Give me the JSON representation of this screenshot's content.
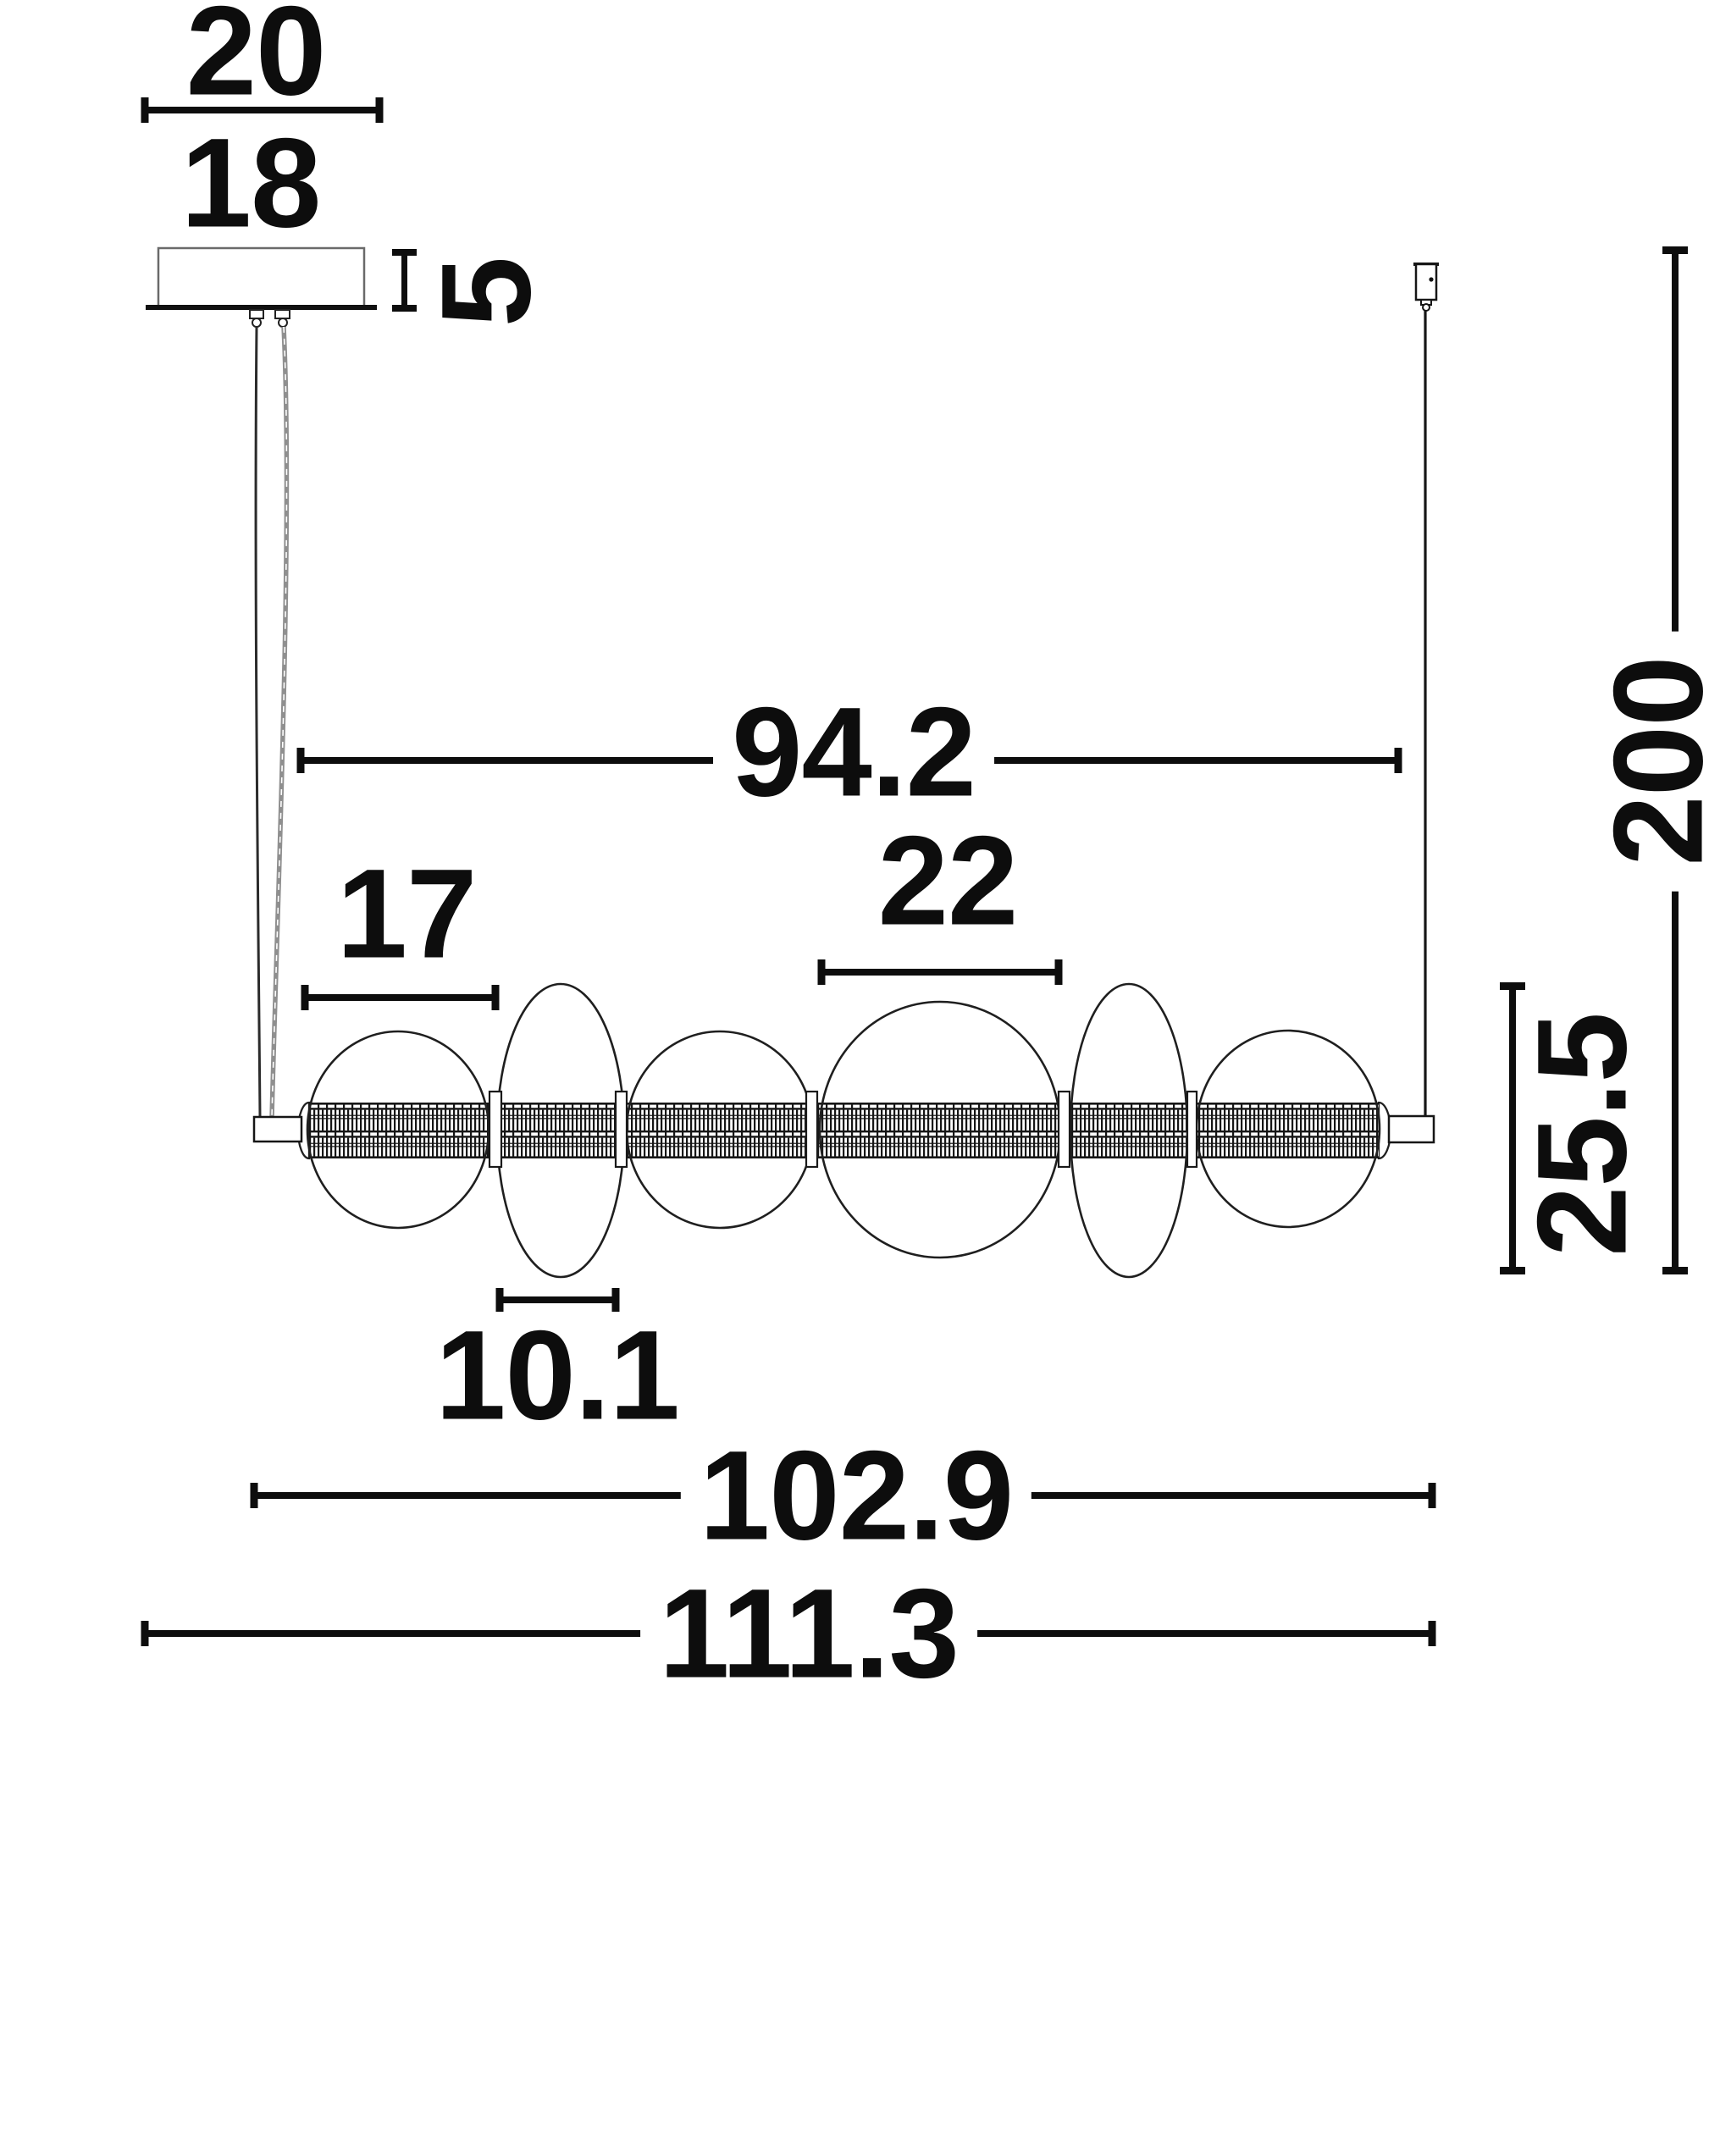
{
  "drawing_type": "pendant-lamp-dimension-diagram",
  "dims": {
    "canopyPlate": "20",
    "canopyBody": "18",
    "canopyHeight": "5",
    "suspensionSpan": "94.2",
    "sphereSmall": "17",
    "sphereLarge": "22",
    "fixtureHeight": "25.5",
    "suspensionDrop": "200",
    "discWidth": "10.1",
    "barLength": "102.9",
    "totalLength": "111.3"
  },
  "colors": {
    "ink": "#0d0d0d",
    "outline": "#1f1f1f",
    "canopyOutline": "#6a6a6a",
    "cordGray": "#8f8f8f",
    "background": "#ffffff"
  }
}
